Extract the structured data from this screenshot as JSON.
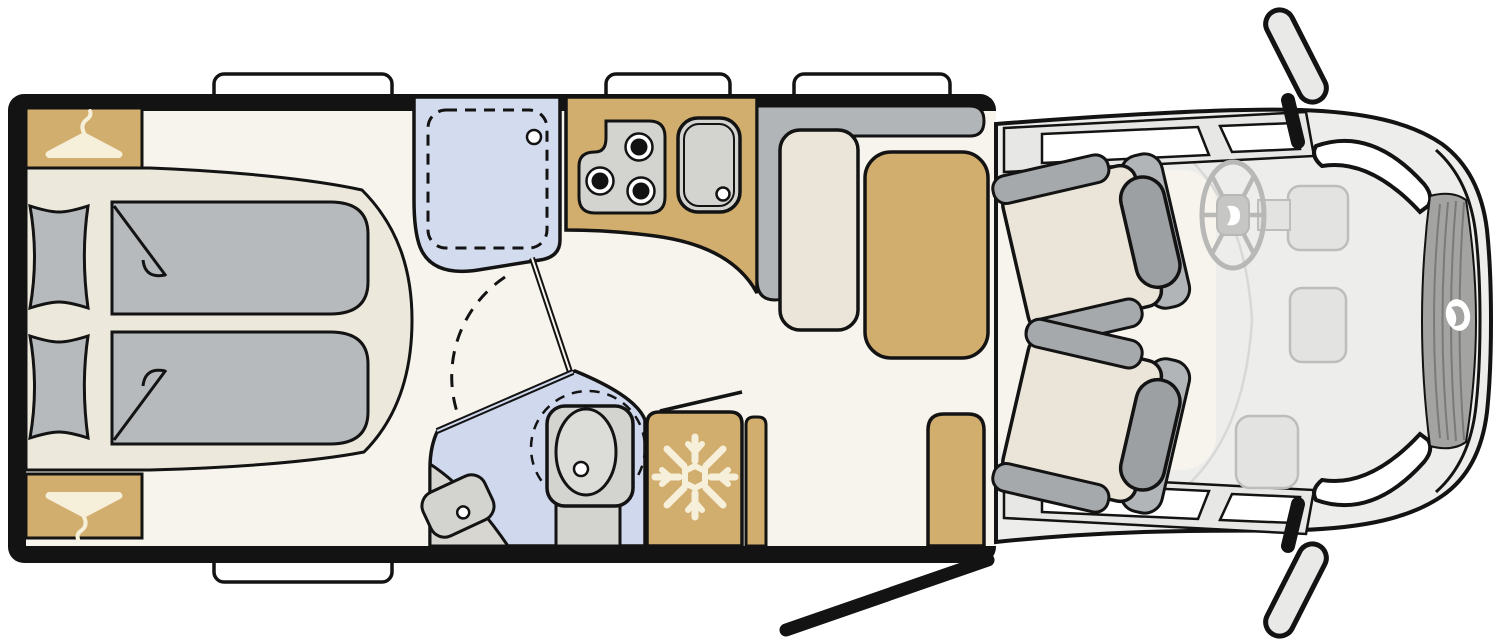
{
  "title": "Motorhome top-view floor plan",
  "palette": {
    "wall": "#131313",
    "white": "#ffffff",
    "floor": "#f7f4ed",
    "platform": "#ece8dc",
    "cushion": "#eae5d8",
    "tan": "#d2ae6e",
    "mattress": "#b7babc",
    "bench": "#b2b5b7",
    "armrest": "#a6a9ab",
    "headrest": "#9da0a2",
    "shower_blue": "#d3dbee",
    "bath_blue": "#cfd8ec",
    "fixture": "#d3d3d0",
    "fixture_light": "#dcdcd9",
    "vanity": "#d8d6d0",
    "cab": "#ededeb",
    "sill": "#e7e7e5",
    "dash": "#e3e3e1",
    "dash_stroke": "#bdbdbb",
    "hood_line": "#d8d8d6",
    "wheel_gray": "#b8b8b6",
    "hub_gray": "#c6c6c4",
    "grille": "#a3a3a1",
    "grille_rib": "#7a7a78",
    "mirror_face": "#e9e9e7",
    "icon_cream": "#f6efd9"
  },
  "floorplan": {
    "vehicle_type": "motorhome (top view)",
    "zones": [
      {
        "name": "rear-bedroom",
        "features": [
          "wardrobe-top",
          "wardrobe-bottom",
          "bed-platform",
          "pillow",
          "pillow",
          "duvet",
          "duvet"
        ]
      },
      {
        "name": "washroom",
        "features": [
          "shower-cabin",
          "shower-tray",
          "shower-drain",
          "swing-door",
          "door-swing-arc",
          "vanity-basin",
          "swivel-toilet"
        ]
      },
      {
        "name": "kitchen",
        "features": [
          "counter",
          "three-burner-hob",
          "sink",
          "refrigerator",
          "cabinet"
        ]
      },
      {
        "name": "dinette",
        "features": [
          "l-bench-backrest",
          "bench-cushion",
          "table",
          "side-seat",
          "entry-door-open"
        ]
      },
      {
        "name": "cab",
        "features": [
          "driver-swivel-seat",
          "passenger-swivel-seat",
          "steering-wheel",
          "dashboard",
          "door-windows",
          "side-mirror",
          "side-mirror",
          "windshield",
          "grille",
          "brand-logo"
        ]
      }
    ],
    "window_count": 4,
    "burner_count": 3
  },
  "icons": {
    "hanger": "hanger-icon",
    "snowflake": "snowflake-icon",
    "steering_wheel": "steering-wheel-icon",
    "brand_logo": "brand-logo-icon",
    "mirror": "side-mirror-icon"
  }
}
